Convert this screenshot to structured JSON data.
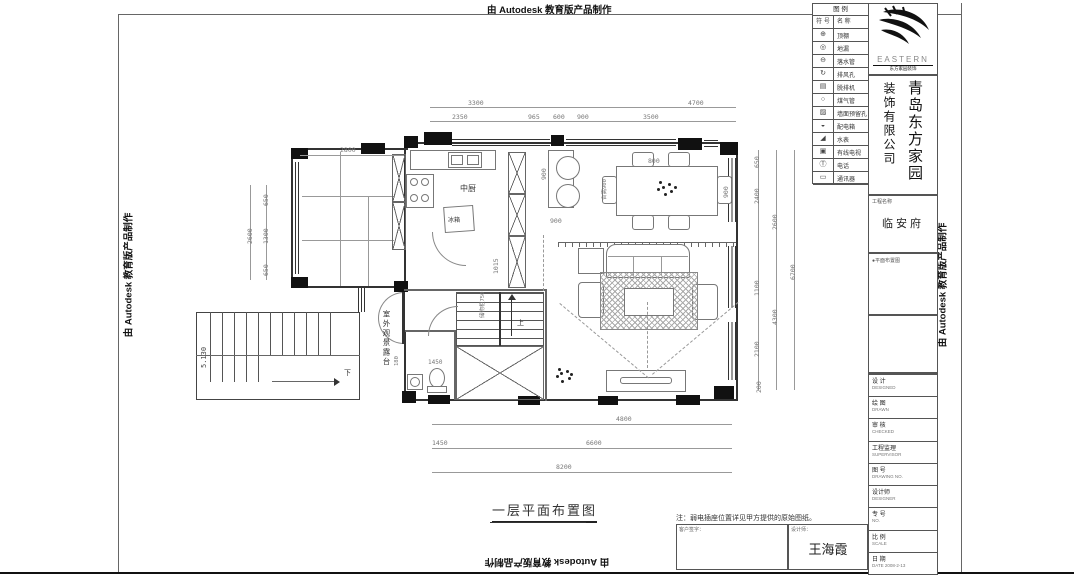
{
  "watermark": {
    "text": "由 Autodesk 教育版产品制作"
  },
  "legend": {
    "title": "图  例",
    "col_symbol": "符 号",
    "col_name": "名 称",
    "rows": [
      {
        "symbol": "⊕",
        "name": "顶棚"
      },
      {
        "symbol": "◎",
        "name": "地漏"
      },
      {
        "symbol": "⊖",
        "name": "落水管"
      },
      {
        "symbol": "↻",
        "name": "排风孔"
      },
      {
        "symbol": "▤",
        "name": "脱排机"
      },
      {
        "symbol": "○",
        "name": "煤气管"
      },
      {
        "symbol": "▨",
        "name": "墙面预留孔"
      },
      {
        "symbol": "◒",
        "name": "配电箱"
      },
      {
        "symbol": "◢",
        "name": "水表"
      },
      {
        "symbol": "▣",
        "name": "有线电视"
      },
      {
        "symbol": "Ⓣ",
        "name": "电话"
      },
      {
        "symbol": "▭",
        "name": "通讯器"
      }
    ]
  },
  "brand": {
    "logo": "EASTERN",
    "logo_sub": "东方家园装饰",
    "company_right": "青岛东方家园",
    "company_left": "装饰有限公司"
  },
  "titleblock": {
    "project_label": "工程名称",
    "project_name": "临安府",
    "spec_note": "●平面布置图",
    "rows": [
      {
        "label": "设 计",
        "sub": "DESIGNED"
      },
      {
        "label": "绘 图",
        "sub": "DRAWN"
      },
      {
        "label": "审 核",
        "sub": "CHECKED"
      },
      {
        "label": "工程监理",
        "sub": "SUPERVISOR"
      },
      {
        "label": "图 号",
        "sub": "DRAWING NO."
      },
      {
        "label": "设计师",
        "sub": "DESIGNER"
      },
      {
        "label": "专 号",
        "sub": "NO."
      },
      {
        "label": "比 例",
        "sub": "SCALE"
      },
      {
        "label": "日 期",
        "sub": "DATE 2008-2-13"
      }
    ]
  },
  "footer": {
    "note": "注：弱电插座位置详见甲方提供的原始图纸。",
    "client_label": "客户签字：",
    "designer_label": "设计师：",
    "designer_name": "王海霞"
  },
  "drawing": {
    "title": "一层平面布置图",
    "rooms": {
      "kitchen": "中厨",
      "fridge": "冰箱",
      "terrace": "室外观景露台",
      "counter": "台高900",
      "storage": "储物柜750"
    },
    "marks": {
      "up": "上",
      "down": "下",
      "level": "5.130"
    },
    "dims": {
      "top1a": "3300",
      "top1b": "4700",
      "t2350": "2350",
      "t965": "965",
      "t600": "600",
      "t900": "900",
      "t3500": "3500",
      "wing2800": "2800",
      "l650a": "650",
      "l1300": "1300",
      "l650b": "650",
      "l2600": "2600",
      "r650": "650",
      "r2400": "2400",
      "r2600": "2600",
      "r1100": "1100",
      "r4300": "4300",
      "r2100": "2100",
      "r6700": "6700",
      "r200": "200",
      "b4800": "4800",
      "b1450": "1450",
      "b6600": "6600",
      "b8200": "8200",
      "d800": "800",
      "d900": "900",
      "k900": "900",
      "k900b": "900",
      "s1015": "1015",
      "bath1450": "1450",
      "t180": "180"
    }
  }
}
